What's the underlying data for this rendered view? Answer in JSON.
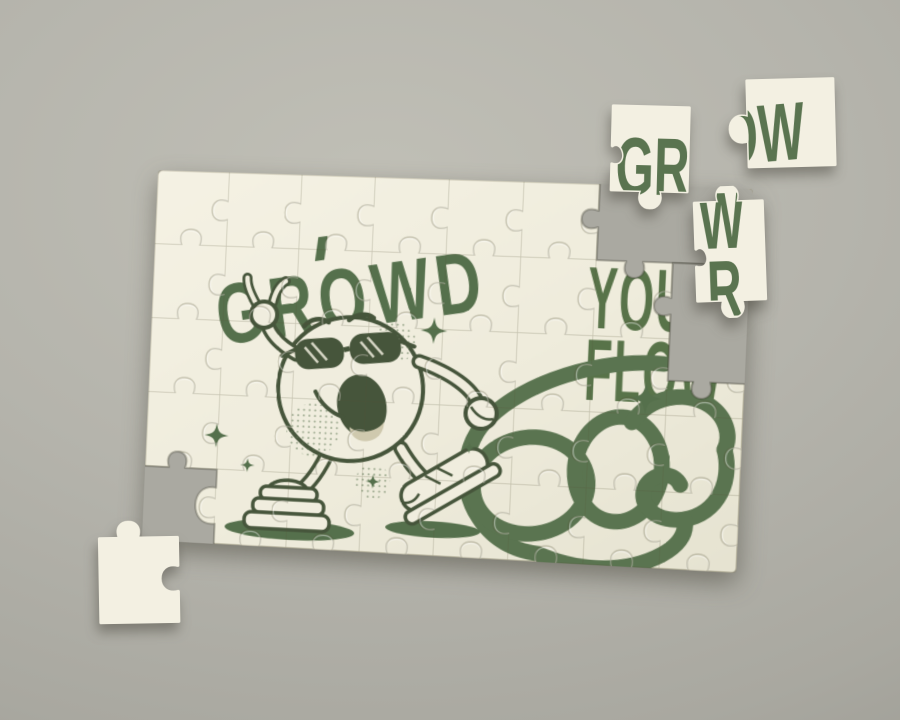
{
  "scene": {
    "title": "Jigsaw puzzle mockup on gray surface",
    "background_hex": "#b3b2aa"
  },
  "palette": {
    "puzzle_cream": "#f2efe0",
    "artwork_green": "#5a7450",
    "artwork_dark_green": "#46553b",
    "hole_gray": "#aaa9a1"
  },
  "main_puzzle": {
    "title": "GROWD",
    "headline": {
      "line1": "GROW",
      "line2": "YOUR",
      "line3": "FLOW"
    }
  },
  "loose_pieces": {
    "piece_gro": {
      "text": "GRO"
    },
    "piece_ow": {
      "text": "OW"
    },
    "piece_wr": {
      "top": "W",
      "bottom": "R"
    },
    "piece_blank": {
      "text": ""
    }
  }
}
